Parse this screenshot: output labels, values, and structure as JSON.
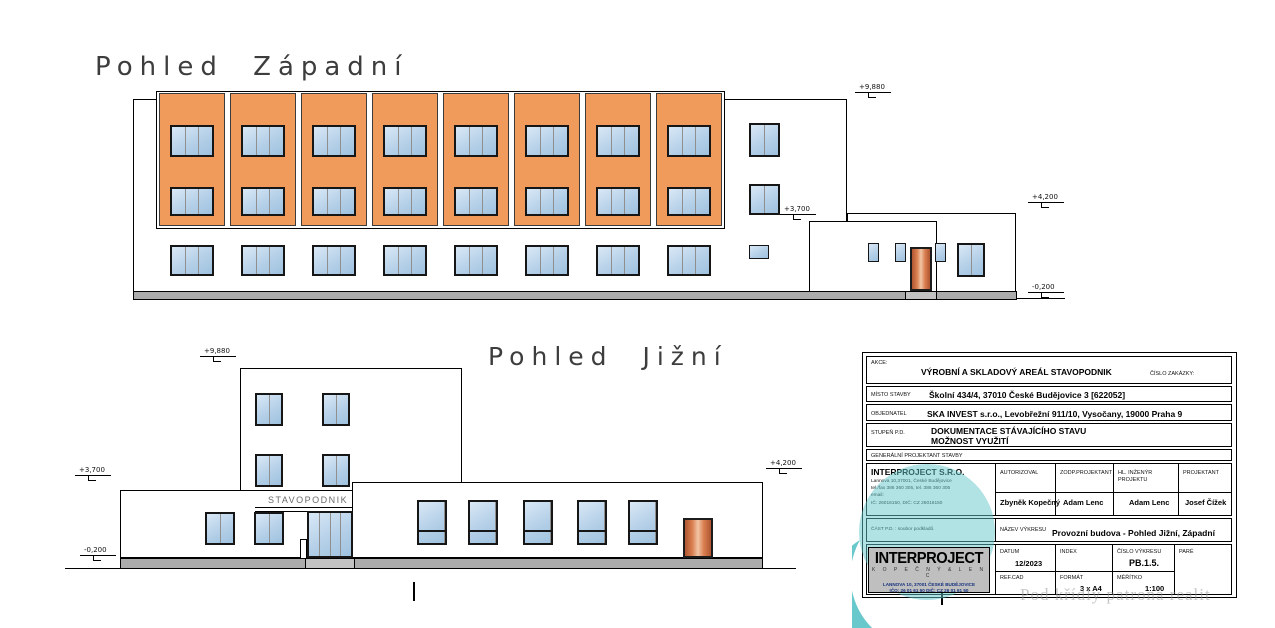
{
  "page": {
    "watermark": "Pod křídly patrona realit"
  },
  "colors": {
    "facade_orange": "#F09A5C",
    "window_blue": "#B5D0E8",
    "plinth_gray": "#ABABAB",
    "door_brown": "#C06038",
    "logo_teal": "#4FC3C7"
  },
  "west_view": {
    "title": "Pohled Západní",
    "markers": {
      "roof": "+9,880",
      "mid": "+3,700",
      "annex_roof": "+4,200",
      "ground": "-0,200"
    },
    "bays": 8,
    "windows_per_bay": 2,
    "ground_windows": 8
  },
  "south_view": {
    "title": "Pohled Jižní",
    "sign": "STAVOPODNIK",
    "markers": {
      "roof": "+9,880",
      "wing_roof": "+3,700",
      "annex_roof": "+4,200",
      "ground": "-0,200"
    },
    "tower_windows": 4,
    "left_wing_windows": 2,
    "right_wing_windows": 5
  },
  "title_block": {
    "akce_label": "AKCE:",
    "akce_value": "VÝROBNÍ A SKLADOVÝ AREÁL STAVOPODNIK",
    "cislo_zakazky_label": "ČÍSLO ZAKÁZKY:",
    "misto_label": "MÍSTO STAVBY",
    "misto_value": "Školní 434/4, 37010 České Budějovice 3 [622052]",
    "objednatel_label": "OBJEDNATEL",
    "objednatel_value": "SKA INVEST s.r.o., Levobřežní 911/10, Vysočany, 19000 Praha 9",
    "stupen_label": "STUPEŇ P.D.",
    "stupen_value_1": "DOKUMENTACE STÁVAJÍCÍHO STAVU",
    "stupen_value_2": "MOŽNOST VYUŽITÍ",
    "gen_label": "GENERÁLNÍ PROJEKTANT STAVBY",
    "company": {
      "name": "INTERPROJECT S.R.O.",
      "line1": "Lannova 10,37001, České Budějovice",
      "line2": "tel./fax 386 360 305, tel. 386 360 305",
      "line3": "email:",
      "line4": "IČ: 26016150, DIČ: CZ 26016150"
    },
    "autorizoval_label": "AUTORIZOVAL",
    "autorizoval_value": "Zbyněk Kopečný",
    "zodp_label": "ZODP.PROJEKTANT",
    "zodp_value": "Adam Lenc",
    "hl_label_1": "HL. INŽENÝR",
    "hl_label_2": "PROJEKTU",
    "hl_value": "Adam Lenc",
    "projektant_label": "PROJEKTANT",
    "projektant_value": "Josef Čížek",
    "cast_label": "ČÁST P.D. : soubor podkladů.",
    "nazev_label": "NÁZEV VÝKRESU",
    "nazev_value": "Provozní budova - Pohled Jižní, Západní",
    "datum_label": "DATUM",
    "datum_value": "12/2023",
    "index_label": "INDEX",
    "cislo_vykresu_label": "ČÍSLO VÝKRESU",
    "cislo_vykresu_value": "PB.1.5.",
    "pare_label": "PARÉ",
    "refcad_label": "REF.CAD",
    "format_label": "FORMÁT",
    "format_value": "3 x A4",
    "meritko_label": "MĚŘÍTKO",
    "meritko_value": "1:100",
    "logo": {
      "name": "INTERPROJECT",
      "sub": "K O P E Č N Ý  &  L E N C",
      "addr": "LANNOVA 10, 37001  ČESKÉ BUDĚJOVICE",
      "ids": "IČO: 26 01 61 50   DIČ: CZ 26 01 61 50"
    }
  }
}
